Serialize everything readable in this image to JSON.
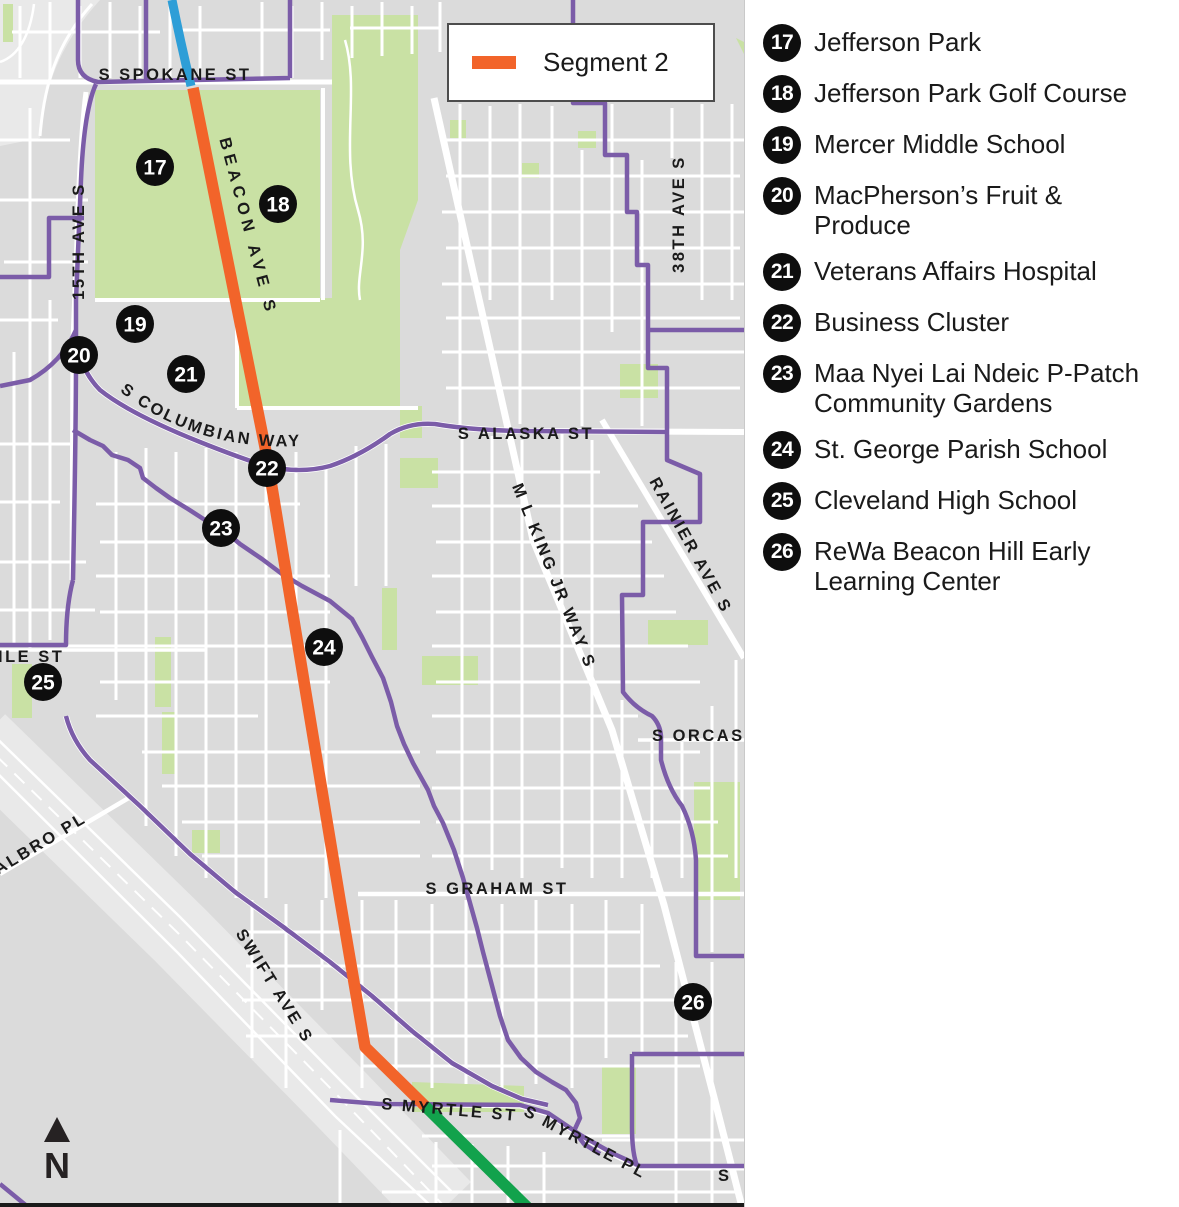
{
  "legend": {
    "label": "Segment 2",
    "segment_color": "#F2642A"
  },
  "north_label": "N",
  "colors": {
    "map_background": "#DBDBDB",
    "street": "#FFFFFF",
    "park_green": "#C9E1A4",
    "route_purple": "#7B5CA8",
    "segment2_orange": "#F2642A",
    "segment1_blue": "#2E9ED7",
    "segment3_green": "#12A24C",
    "freeway_gray": "#E7E7E7",
    "marker_black": "#0E0E0E"
  },
  "map": {
    "street_labels": [
      {
        "text": "S SPOKANE ST"
      },
      {
        "text": "15TH AVE S"
      },
      {
        "text": "BEACON AVE S"
      },
      {
        "text": "S  COLUMBIAN  WAY"
      },
      {
        "text": "S ALASKA ST"
      },
      {
        "text": "M L KING JR WAY S"
      },
      {
        "text": "RAINIER AVE S"
      },
      {
        "text": "38TH AVE S"
      },
      {
        "text": "S ORCAS"
      },
      {
        "text": "S GRAHAM ST"
      },
      {
        "text": "SWIFT AVE S"
      },
      {
        "text": "ALBRO PL"
      },
      {
        "text": "ILE ST"
      },
      {
        "text": "S MYRTLE ST"
      },
      {
        "text": "S MYRTLE PL"
      },
      {
        "text": "S"
      }
    ],
    "markers": [
      {
        "number": "17"
      },
      {
        "number": "18"
      },
      {
        "number": "19"
      },
      {
        "number": "20"
      },
      {
        "number": "21"
      },
      {
        "number": "22"
      },
      {
        "number": "23"
      },
      {
        "number": "24"
      },
      {
        "number": "25"
      },
      {
        "number": "26"
      }
    ]
  },
  "locations": [
    {
      "number": "17",
      "label": "Jefferson Park"
    },
    {
      "number": "18",
      "label": "Jefferson Park Golf Course"
    },
    {
      "number": "19",
      "label": "Mercer Middle School"
    },
    {
      "number": "20",
      "label": "MacPherson’s Fruit & Produce"
    },
    {
      "number": "21",
      "label": "Veterans Affairs Hospital"
    },
    {
      "number": "22",
      "label": "Business Cluster"
    },
    {
      "number": "23",
      "label": "Maa Nyei Lai Ndeic P-Patch Community Gardens"
    },
    {
      "number": "24",
      "label": "St. George Parish School"
    },
    {
      "number": "25",
      "label": "Cleveland High School"
    },
    {
      "number": "26",
      "label": "ReWa Beacon Hill Early Learning Center"
    }
  ]
}
